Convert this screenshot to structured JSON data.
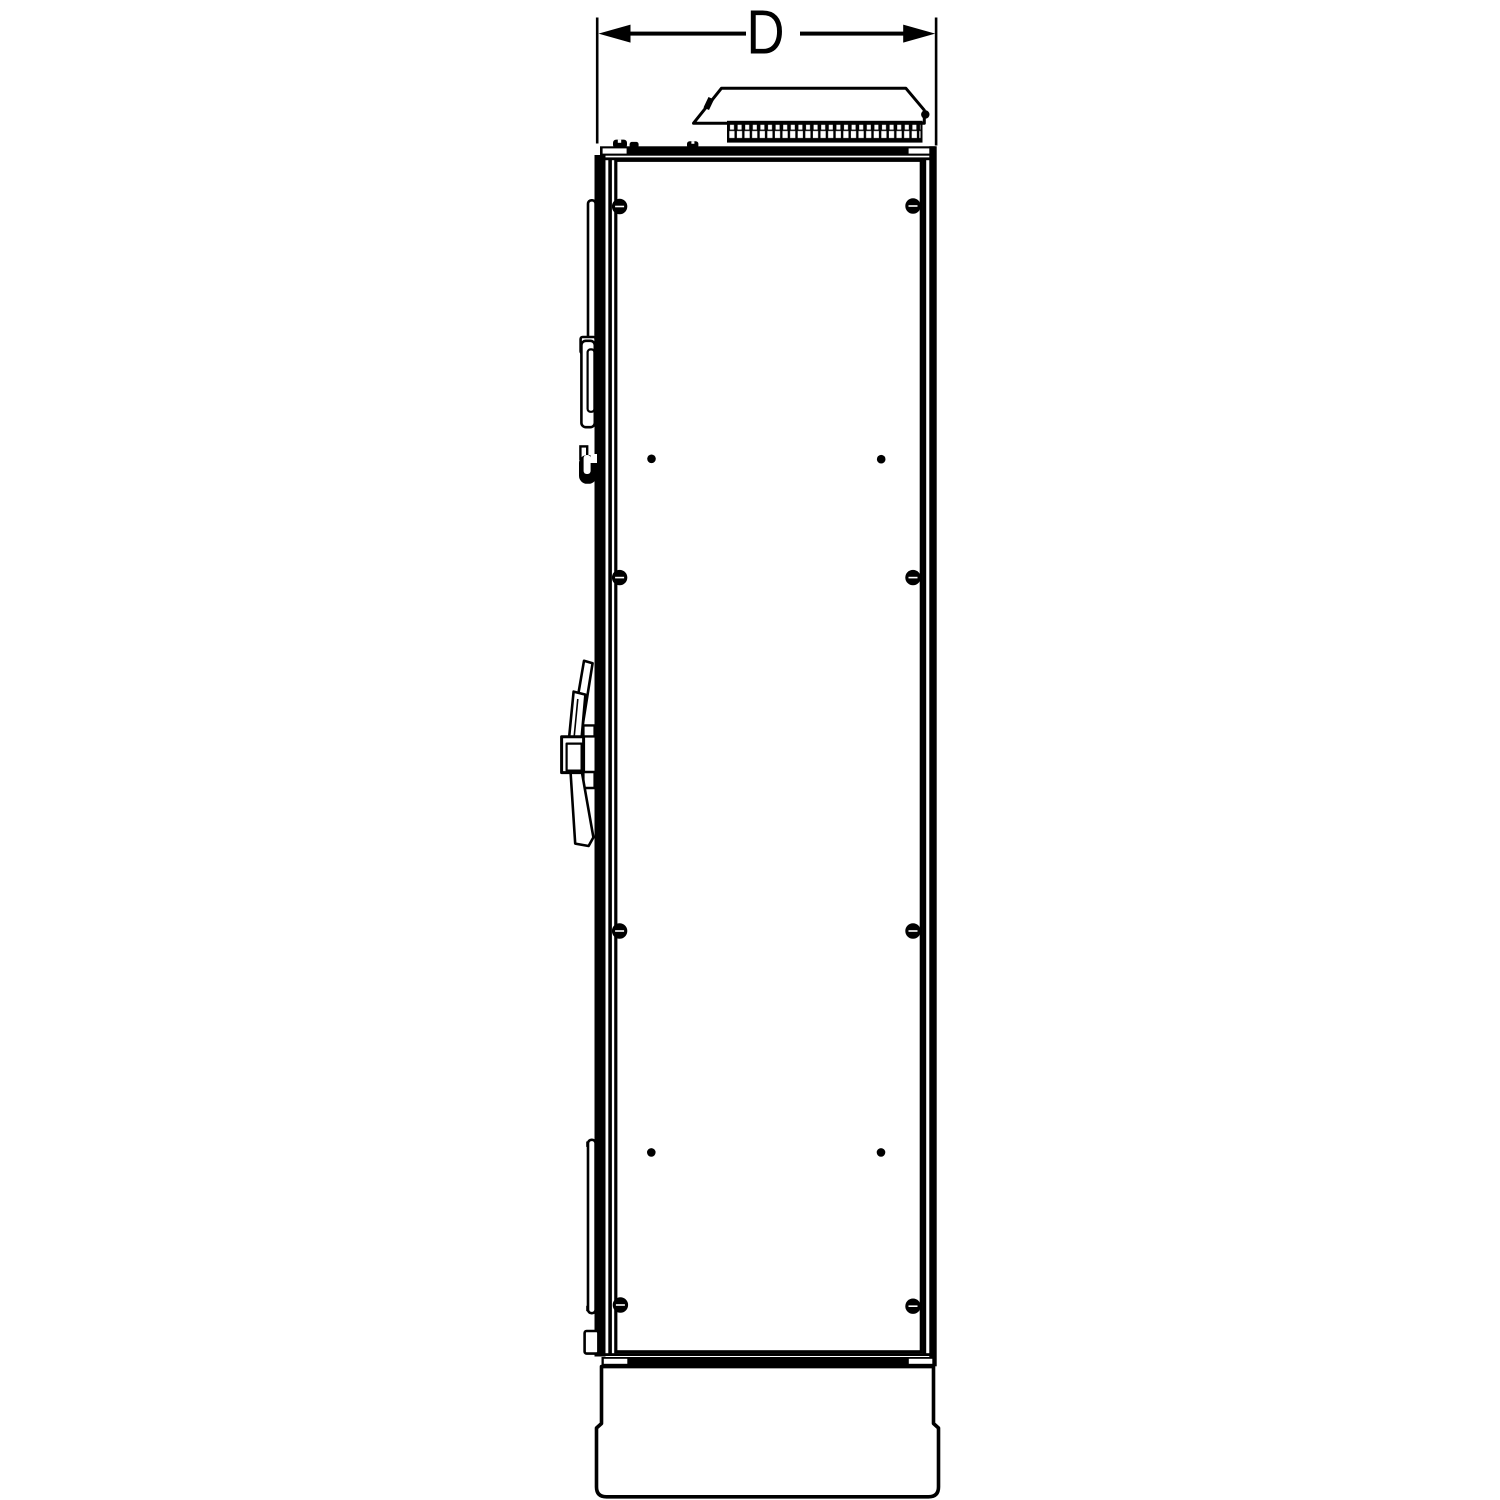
{
  "page": {
    "background_color": "#ffffff"
  },
  "drawing": {
    "type": "technical-line-drawing",
    "subject": "electrical enclosure cabinet, side elevation view",
    "line_color": "#000000",
    "dimension": {
      "label": "D"
    }
  }
}
